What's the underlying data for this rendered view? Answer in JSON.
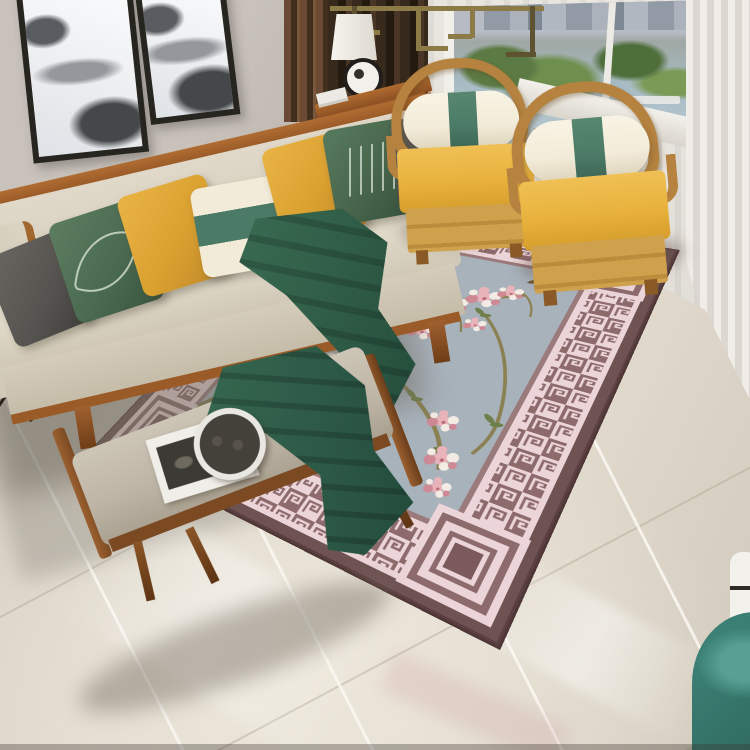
{
  "scene": {
    "setting": "living room photograph, angled top-down view",
    "style": "modern Chinese interior",
    "objects": [
      {
        "name": "wall-art",
        "detail": "two black-framed ink-wash mountain prints, tops cropped"
      },
      {
        "name": "sofa",
        "detail": "beige fabric sofa with exposed wood frame and left arm panel"
      },
      {
        "name": "sofa-pillows",
        "detail": [
          "charcoal",
          "green with leaf motif",
          "mustard",
          "cream with green center band",
          "mustard",
          "green with white script",
          "charcoal"
        ]
      },
      {
        "name": "throw-blanket",
        "detail": "dark green cloth draped over seat and hanging off the front"
      },
      {
        "name": "armchairs",
        "detail": "two wooden horseshoe-back chairs with yellow cushions and cream bolster pillows with green center band"
      },
      {
        "name": "area-rug",
        "detail": "mauve and pink greek-key meander border, nested-square corner medallions, blue-gray field with cherry blossom branches, gnarled olive trunk and flying bird"
      },
      {
        "name": "bench",
        "detail": "wood-frame bench with gray cushion, dark green runner, open magazine and black decorative plate"
      },
      {
        "name": "window",
        "detail": "white sheer curtains, outside view of buildings, trees and water"
      },
      {
        "name": "dark-curtain",
        "detail": "dark brown curtain panel and wood slat screen beside the window"
      },
      {
        "name": "console-table",
        "detail": "small wood side table with black x-legs, white table lamp and round black-rimmed decor"
      },
      {
        "name": "ceiling-light",
        "detail": "brass geometric chinese-style fixture at top center"
      },
      {
        "name": "floor",
        "detail": "glossy cream marble tiles with diagonal grout lines and reflections"
      },
      {
        "name": "corner-decor",
        "detail": "teal vessel and white striped vase at bottom-right edge"
      }
    ]
  },
  "palette": {
    "wall": "#c8c2bb",
    "wall-shade": "#b7b1a9",
    "floor": "#dcd5c7",
    "floor-light": "#ece6da",
    "curtain-dark": "#38291d",
    "curtain-light": "#e9e6e0",
    "window-trees": "#5c7a43",
    "window-water": "#a9bdc7",
    "window-sky": "#b7bcc4",
    "sofa-fabric": "#d8d0bf",
    "sofa-seat": "#ded7c6",
    "sofa-wood": "#9a5b28",
    "pillow-charcoal": "#55534f",
    "pillow-green": "#4b6b51",
    "pillow-mustard": "#d9a02f",
    "pillow-cream": "#f2ebd8",
    "band-green": "#4b7a66",
    "throw-green": "#2e5a45",
    "chair-wood": "#b5823f",
    "chair-cushion": "#e8b23c",
    "chair-base": "#cfa14c",
    "rug-outer": "#6f5353",
    "rug-band": "#8d6a6c",
    "rug-pink": "#ecd5d8",
    "rug-line": "#9b7a7c",
    "rug-field": "#a8b2bb",
    "trunk-olive": "#7b7a4c",
    "branch-olive": "#8a8052",
    "leaf-green": "#6f7f49",
    "blossom-pink": "#e9b3ba",
    "blossom-deep": "#cf8995",
    "blossom-white": "#f3ece4",
    "bench-wood": "#7c4a22",
    "bench-cushion": "#beb5a6",
    "runner-green": "#2d5947",
    "book-white": "#f0eee9",
    "vase-teal": "#3f867b",
    "frame-black": "#26251f",
    "art-ink": "#45484b",
    "fixture-brass": "#8d7b47"
  }
}
